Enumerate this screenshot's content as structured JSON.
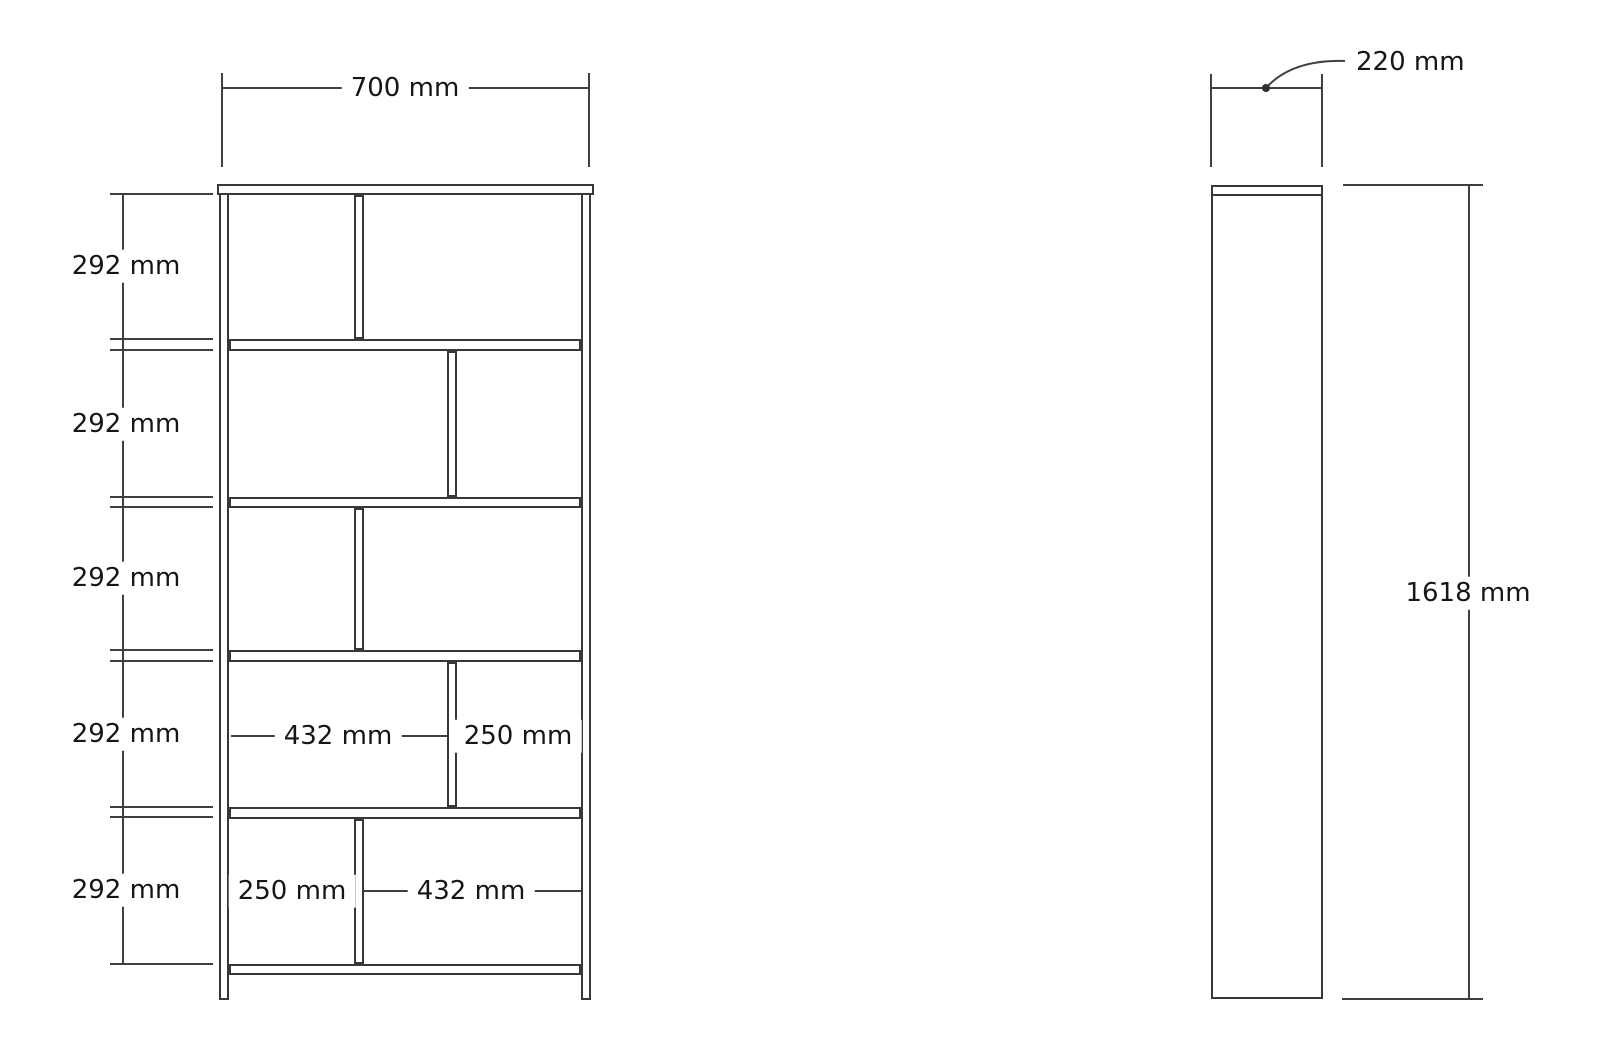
{
  "front_view": {
    "width_dimension": "700 mm",
    "row_heights": [
      "292 mm",
      "292 mm",
      "292 mm",
      "292 mm",
      "292 mm"
    ],
    "row4": {
      "left": "432 mm",
      "right": "250 mm"
    },
    "row5": {
      "left": "250 mm",
      "right": "432 mm"
    }
  },
  "side_view": {
    "depth_dimension": "220 mm",
    "height_dimension": "1618 mm"
  },
  "colors": {
    "line": "#383838",
    "dimension": "#404040",
    "text": "#161616",
    "background": "#ffffff"
  }
}
